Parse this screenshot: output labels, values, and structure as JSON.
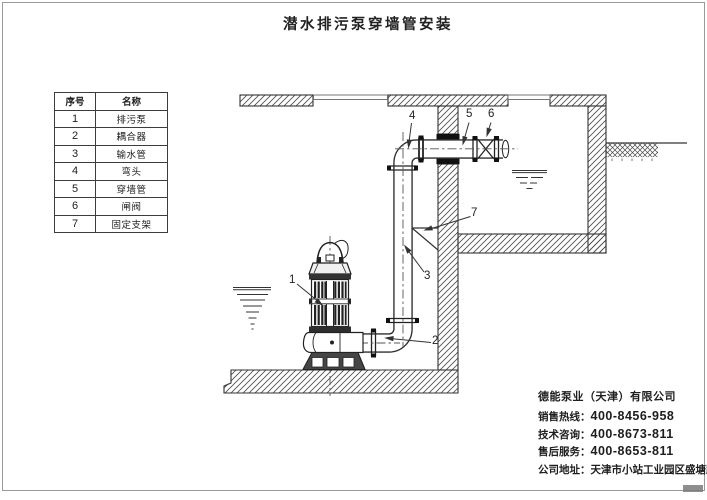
{
  "page": {
    "title": "潜水排污泵穿墙管安装"
  },
  "parts_table": {
    "headers": [
      "序号",
      "名称"
    ],
    "rows": [
      {
        "no": "1",
        "name": "排污泵"
      },
      {
        "no": "2",
        "name": "耦合器"
      },
      {
        "no": "3",
        "name": "输水管"
      },
      {
        "no": "4",
        "name": "弯头"
      },
      {
        "no": "5",
        "name": "穿墙管"
      },
      {
        "no": "6",
        "name": "闸阀"
      },
      {
        "no": "7",
        "name": "固定支架"
      }
    ]
  },
  "callouts": [
    "1",
    "2",
    "3",
    "4",
    "5",
    "6",
    "7"
  ],
  "company": {
    "name": "德能泵业（天津）有限公司",
    "lines": [
      {
        "label": "销售热线：",
        "value": "400-8456-958"
      },
      {
        "label": "技术咨询：",
        "value": "400-8673-811"
      },
      {
        "label": "售后服务：",
        "value": "400-8653-811"
      },
      {
        "label": "公司地址：",
        "value": "天津市小站工业园区盛塘路9号"
      }
    ]
  },
  "colors": {
    "line": "#333333",
    "hatch": "#4a4a4a",
    "sleeve": "#111111",
    "background": "#ffffff",
    "frame": "#9a9a9a"
  }
}
